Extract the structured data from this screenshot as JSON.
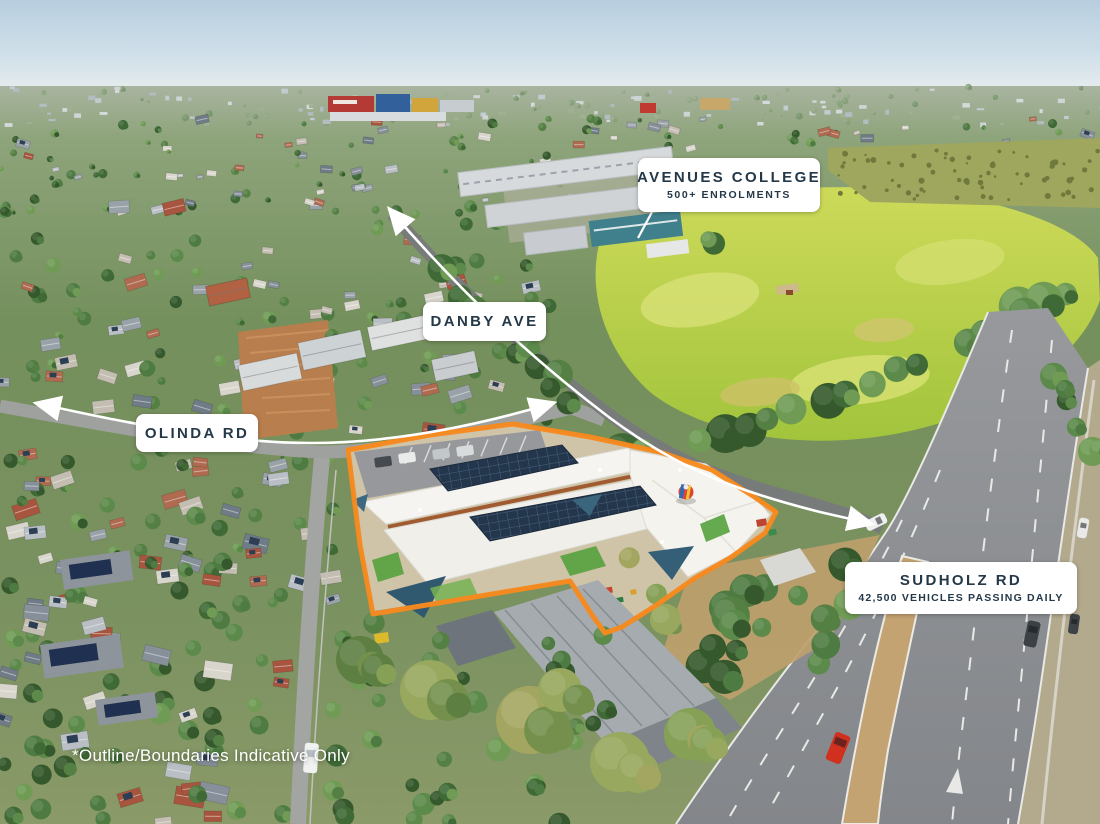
{
  "labels": {
    "college": {
      "title": "AVENUES COLLEGE",
      "subtitle": "500+ ENROLMENTS"
    },
    "danby": {
      "title": "DANBY AVE"
    },
    "olinda": {
      "title": "OLINDA RD"
    },
    "sudholz": {
      "title": "SUDHOLZ RD",
      "subtitle": "42,500 VEHICLES PASSING DAILY"
    }
  },
  "disclaimer": "*Outline/Boundaries Indicative Only",
  "annotations": {
    "property_outline_icon": "orange-boundary-outline",
    "arrow_icons": [
      "olinda-road-arrow",
      "danby-ave-arrow"
    ]
  },
  "colors": {
    "property_outline": "#f6891e",
    "annotation_line": "#ffffff",
    "label_background": "#ffffff",
    "label_text": "#243848"
  }
}
